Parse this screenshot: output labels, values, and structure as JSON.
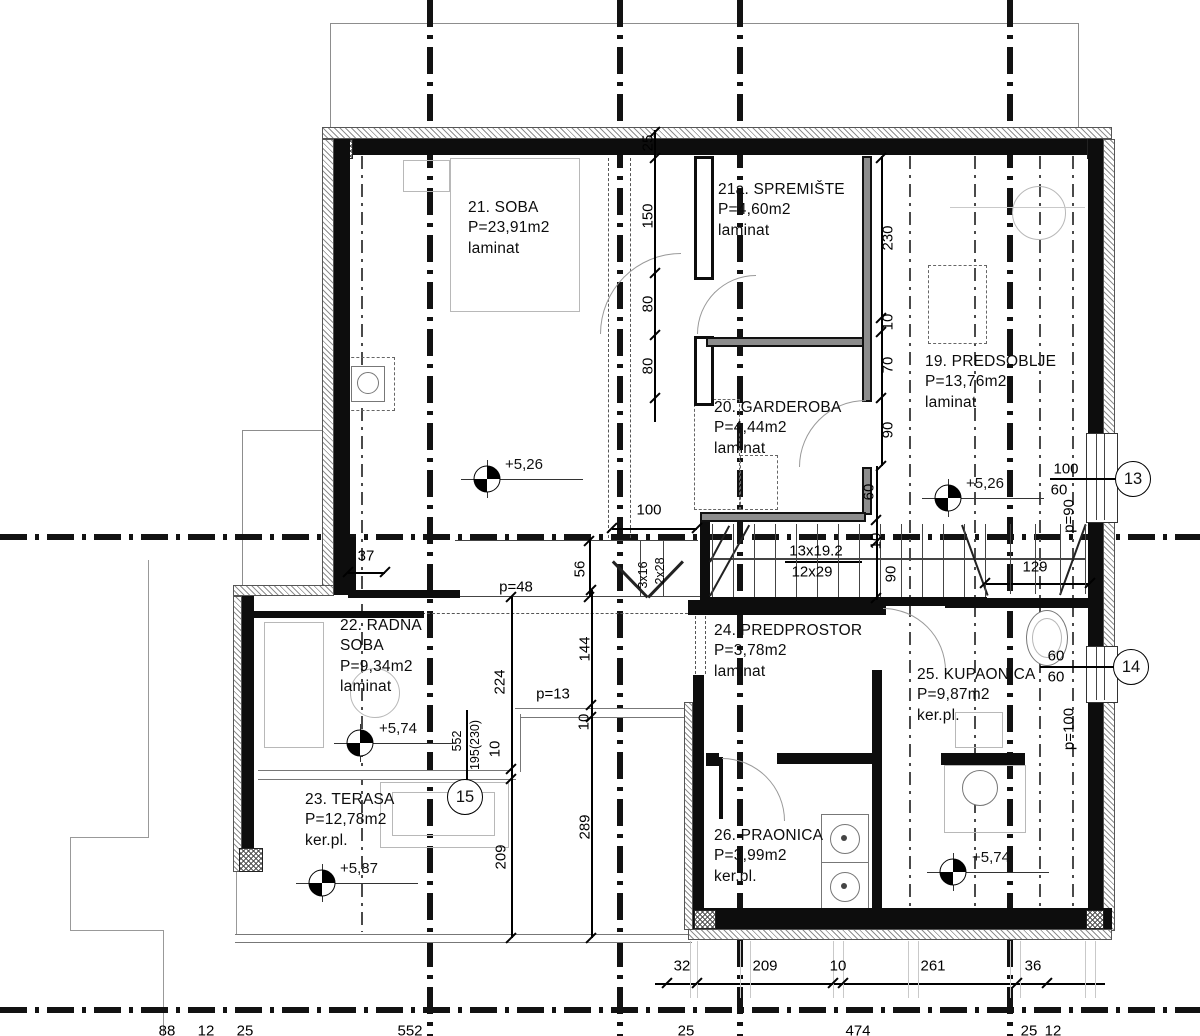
{
  "rooms": [
    {
      "name": "21. SOBA",
      "area": "P=23,91m2",
      "floor": "laminat"
    },
    {
      "name": "21a. SPREMIŠTE",
      "area": "P=4,60m2",
      "floor": "laminat"
    },
    {
      "name": "19. PREDSOBLJE",
      "area": "P=13,76m2",
      "floor": "laminat"
    },
    {
      "name": "20. GARDEROBA",
      "area": "P=4,44m2",
      "floor": "laminat"
    },
    {
      "name": "22. RADNA SOBA",
      "area": "P=9,34m2",
      "floor": "laminat"
    },
    {
      "name": "23. TERASA",
      "area": "P=12,78m2",
      "floor": "ker.pl."
    },
    {
      "name": "24. PREDPROSTOR",
      "area": "P=3,78m2",
      "floor": "laminat"
    },
    {
      "name": "25. KUPAONICA",
      "area": "P=9,87m2",
      "floor": "ker.pl."
    },
    {
      "name": "26. PRAONICA",
      "area": "P=3,99m2",
      "floor": "ker.pl."
    }
  ],
  "elevations": {
    "soba": "+5,26",
    "predsoblje": "+5,26",
    "radna": "+5,74",
    "terasa": "+5,87",
    "kupaonica": "+5,74"
  },
  "position_markers": {
    "m13": "13",
    "m14": "14",
    "m15": "15"
  },
  "stairs": {
    "main_top": "13x19.2",
    "main_bottom": "12x29",
    "small_top": "3x16",
    "small_bottom": "2x28"
  },
  "dims": {
    "chain_top": [
      "25",
      "150",
      "80",
      "80"
    ],
    "chain_right_upper": [
      "230",
      "10",
      "70",
      "90"
    ],
    "chain_right_lower": [
      "60",
      "10",
      "90"
    ],
    "opening_100": "100",
    "dim_129": "129",
    "dim_37": "37",
    "dim_56": "56",
    "p_48": "p=48",
    "p_13": "p=13",
    "p_90": "p=90",
    "p_100": "p=100",
    "dim_144": "144",
    "dim_10a": "10",
    "dim_289": "289",
    "dim_224": "224",
    "dim_10b": "10",
    "dim_209v": "209",
    "frac_552": "552",
    "frac_195": "195(230)",
    "win13_top": "100",
    "win13_bottom": "60",
    "win14_top": "60",
    "win14_bottom": "60",
    "chain_bottom": [
      "32",
      "209",
      "10",
      "261",
      "36"
    ],
    "chain_bottom2": [
      "88",
      "12",
      "25",
      "552",
      "25",
      "474",
      "25",
      "12"
    ]
  }
}
